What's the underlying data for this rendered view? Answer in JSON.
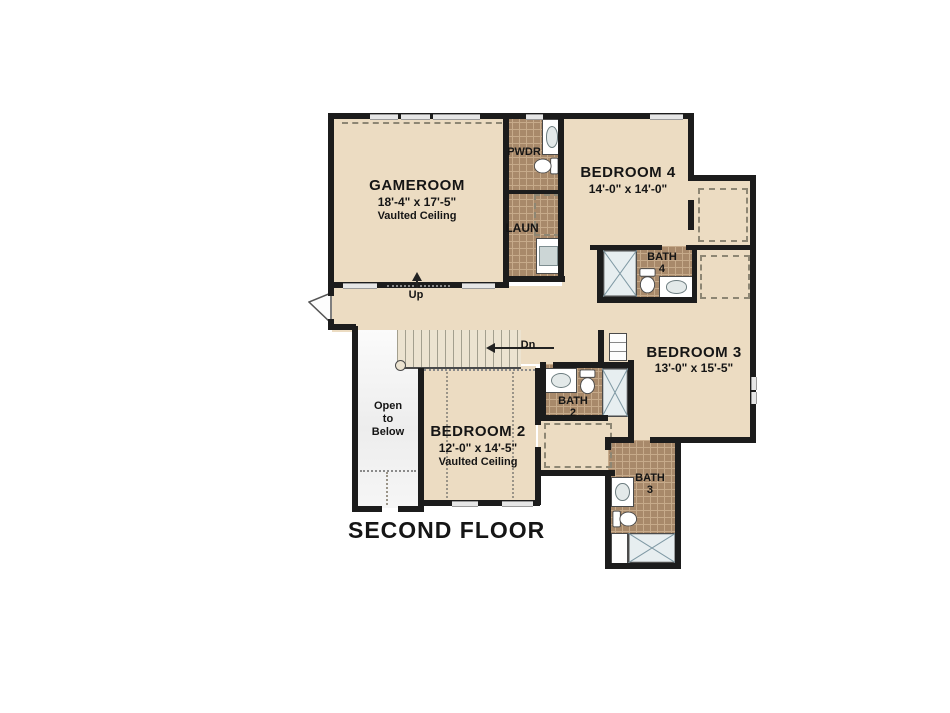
{
  "title": "SECOND FLOOR",
  "rooms": {
    "gameroom": {
      "name": "GAMEROOM",
      "dims": "18'-4\" x 17'-5\"",
      "ceiling": "Vaulted Ceiling"
    },
    "pwdr": {
      "name": "PWDR"
    },
    "laun": {
      "name": "LAUN"
    },
    "bedroom4": {
      "name": "BEDROOM 4",
      "dims": "14'-0\" x 14'-0\""
    },
    "bath4": {
      "name": "BATH",
      "number": "4"
    },
    "bedroom3": {
      "name": "BEDROOM 3",
      "dims": "13'-0\" x 15'-5\""
    },
    "bath2": {
      "name": "BATH",
      "number": "2"
    },
    "bedroom2": {
      "name": "BEDROOM 2",
      "dims": "12'-0\" x 14'-5\"",
      "ceiling": "Vaulted Ceiling"
    },
    "bath3": {
      "name": "BATH",
      "number": "3"
    },
    "open_below": {
      "line1": "Open",
      "line2": "to",
      "line3": "Below"
    }
  },
  "stairs": {
    "up_label": "Up",
    "down_label": "Dn"
  },
  "icons": {
    "toilet": "toilet-icon",
    "sink": "sink-basin-icon",
    "shower": "shower-x-icon",
    "washer": "washer-icon",
    "door": "door-swing-icon"
  },
  "colors": {
    "wall": "#1c1c1c",
    "floor": "#ecdcc2",
    "tile": "#a8896a",
    "grout": "#c6aa8a",
    "window": "#e6e6e6",
    "stair": "#ece3d0",
    "stairline": "#a39f8e",
    "obtop": "#fbfbfb",
    "dash": "#8d8673",
    "text": "#151515",
    "fixstroke": "#4a4a4a"
  }
}
